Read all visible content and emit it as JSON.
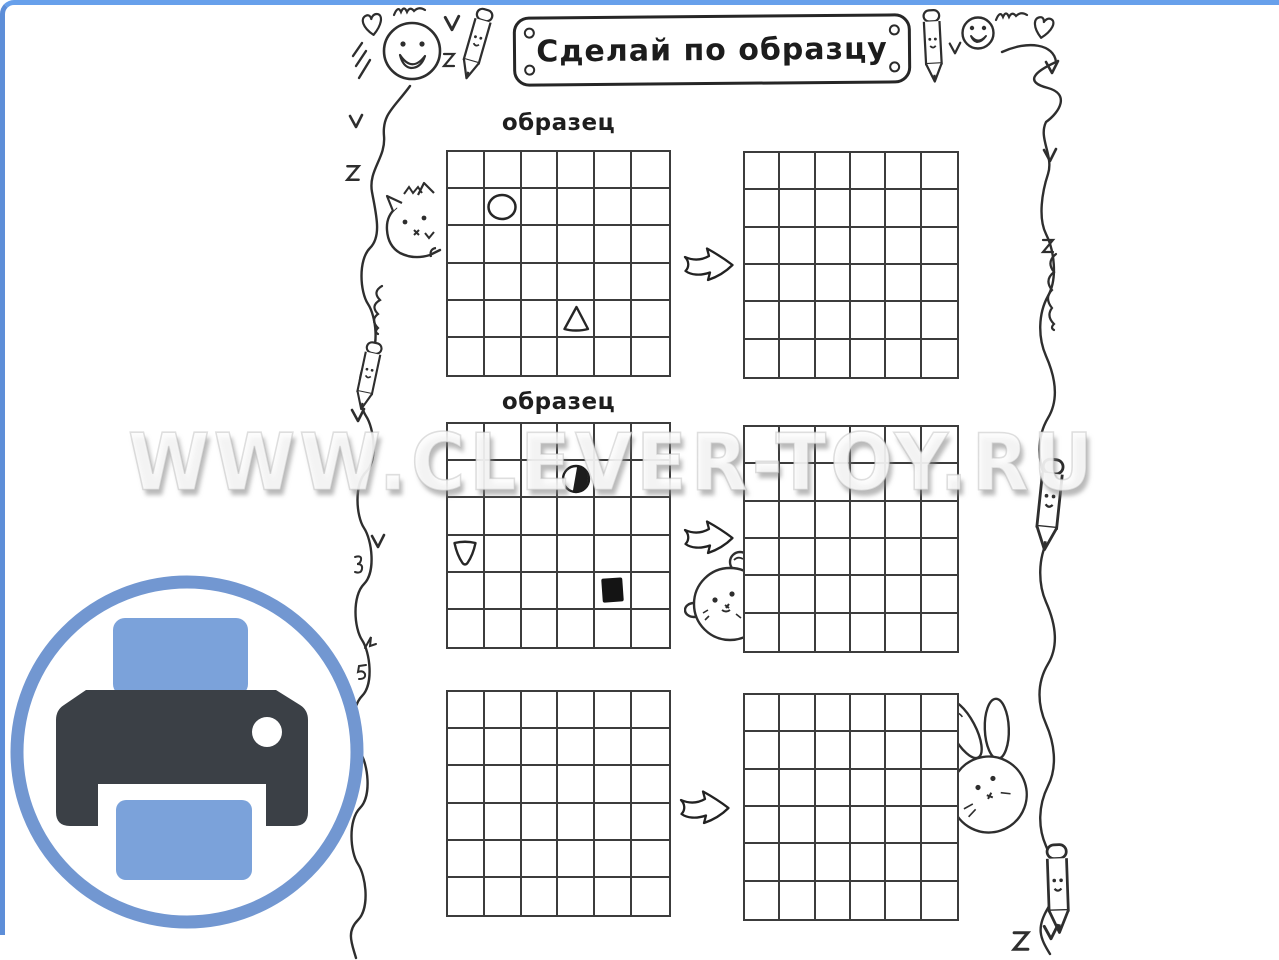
{
  "page": {
    "title_banner": "Сделай по образцу",
    "watermark": "WWW.CLEVER-TOY.RU"
  },
  "colors": {
    "top_edge_blue": "#67a0eb",
    "left_edge_blue": "#5d8ed8",
    "grid_line": "#3c3c3c",
    "ink": "#2e2e2e",
    "print_ring_blue": "#7297d1",
    "print_paper_blue": "#7ba2da",
    "print_body_dark": "#3b4046"
  },
  "worksheet": {
    "grid_rows": 6,
    "grid_cols": 6,
    "rows": [
      {
        "label": "образец",
        "sample_shapes": [
          {
            "shape": "circle-outline",
            "row": 2,
            "col": 2
          },
          {
            "shape": "triangle-up-outline",
            "row": 5,
            "col": 4
          }
        ],
        "target_shapes": []
      },
      {
        "label": "образец",
        "sample_shapes": [
          {
            "shape": "circle-half-filled",
            "row": 2,
            "col": 4
          },
          {
            "shape": "triangle-down-outline",
            "row": 4,
            "col": 1
          },
          {
            "shape": "square-filled",
            "row": 5,
            "col": 5
          }
        ],
        "target_shapes": []
      },
      {
        "label": "",
        "sample_shapes": [],
        "target_shapes": []
      }
    ]
  },
  "decorations": [
    "smiley-face-icon",
    "heart-icon",
    "pencil-icon",
    "checkmark-icon",
    "squiggle-icon",
    "hatch-scribble-icon",
    "wavy-line",
    "cat-icon",
    "bear-icon",
    "bunny-icon",
    "arrow-icon",
    "print-icon"
  ]
}
